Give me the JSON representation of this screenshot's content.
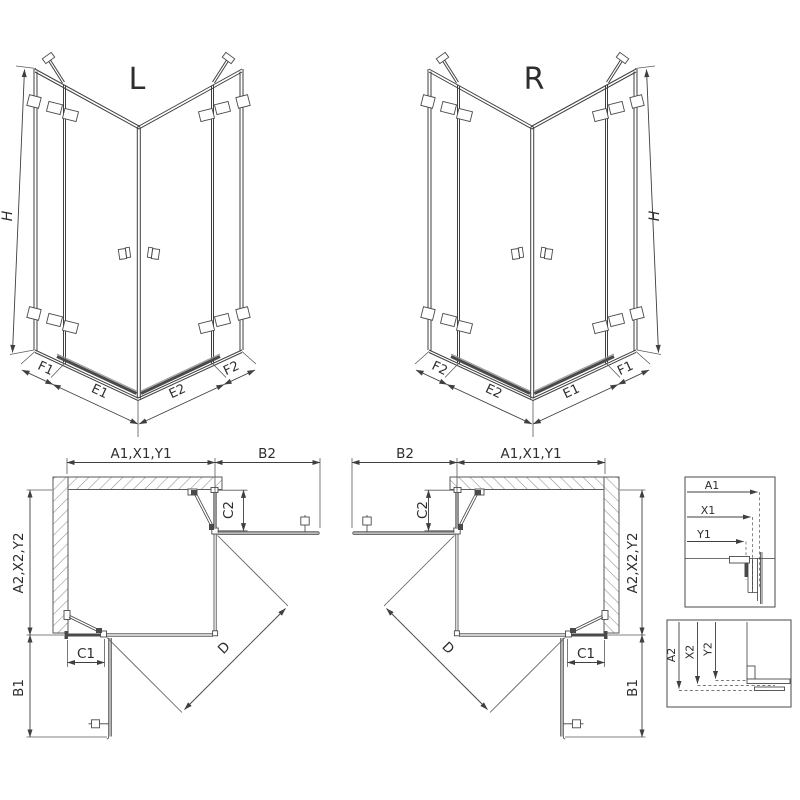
{
  "drawing": {
    "front_views": {
      "left": {
        "title": "L",
        "height_label": "H",
        "bottom_labels": [
          "F1",
          "E1",
          "E2",
          "F2"
        ]
      },
      "right": {
        "title": "R",
        "height_label": "H",
        "bottom_labels": [
          "F2",
          "E2",
          "E1",
          "F1"
        ]
      }
    },
    "plan_views": {
      "left": {
        "width_label": "A1,X1,Y1",
        "side_panel_label": "B2",
        "fixed_top_label": "C2",
        "depth_label": "A2,X2,Y2",
        "fixed_bottom_label": "C1",
        "side_panel_bottom_label": "B1",
        "diagonal_label": "D"
      },
      "right": {
        "width_label": "A1,X1,Y1",
        "side_panel_label": "B2",
        "fixed_top_label": "C2",
        "depth_label": "A2,X2,Y2",
        "fixed_bottom_label": "C1",
        "side_panel_bottom_label": "B1",
        "diagonal_label": "D"
      }
    },
    "detail_views": {
      "top": {
        "labels": [
          "A1",
          "X1",
          "Y1"
        ]
      },
      "bottom": {
        "labels": [
          "A2",
          "X2",
          "Y2"
        ]
      }
    },
    "colors": {
      "line": "#3f3f3f",
      "medium_line": "#6f6f6f",
      "hatch": "#8f8f8f",
      "threshold": "#4a4a4a",
      "background": "#ffffff"
    }
  }
}
